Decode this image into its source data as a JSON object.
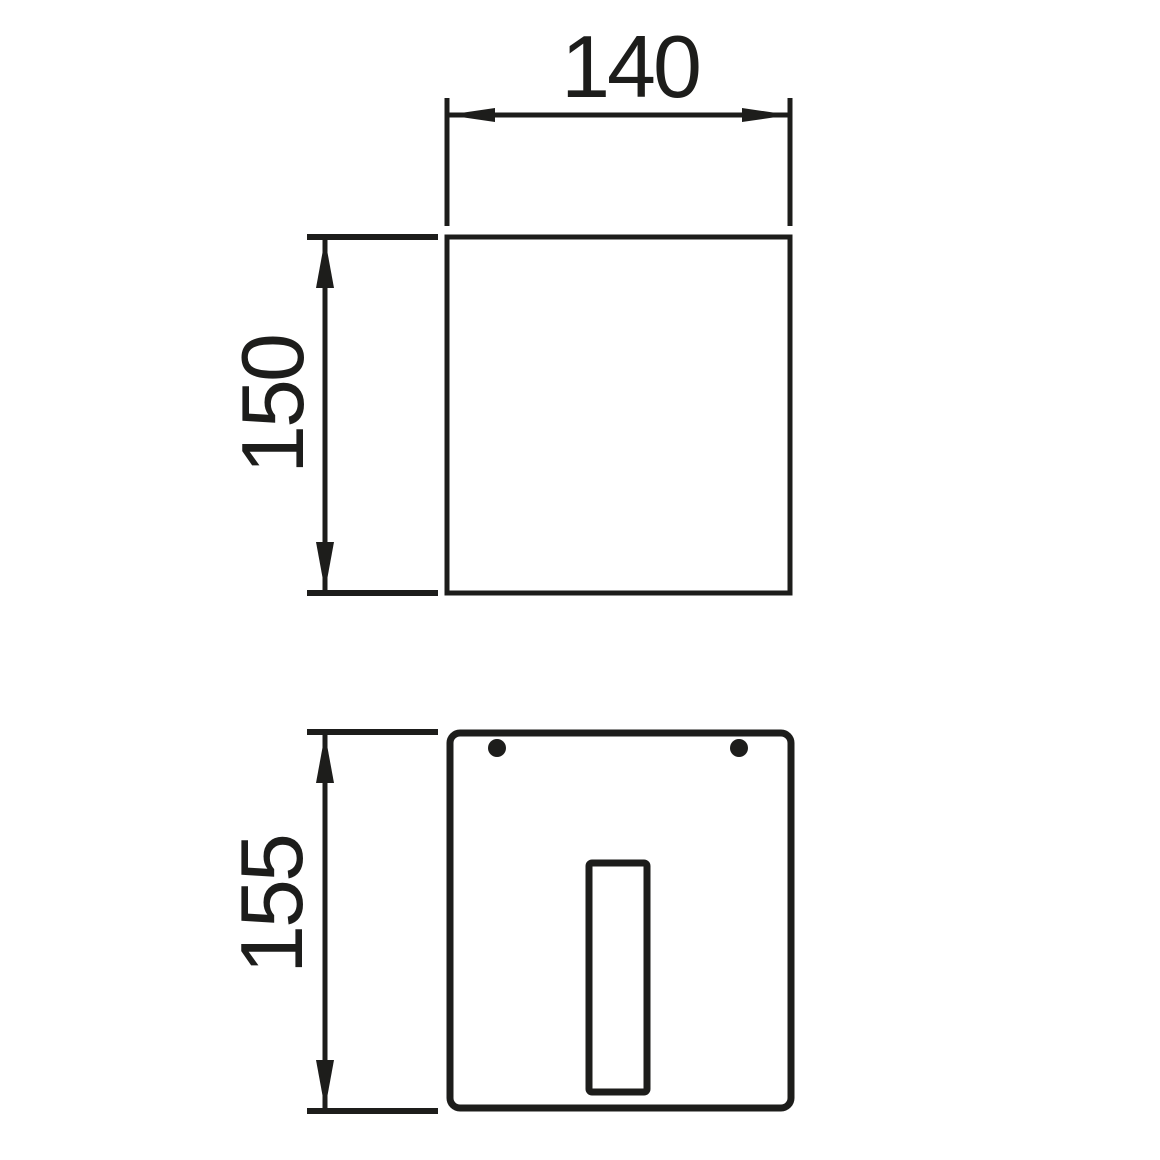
{
  "drawing": {
    "background_color": "#ffffff",
    "line_color": "#1d1d1b",
    "views": {
      "front": {
        "width_dim": "140",
        "height_dim": "150"
      },
      "rear": {
        "height_dim": "155"
      }
    }
  }
}
